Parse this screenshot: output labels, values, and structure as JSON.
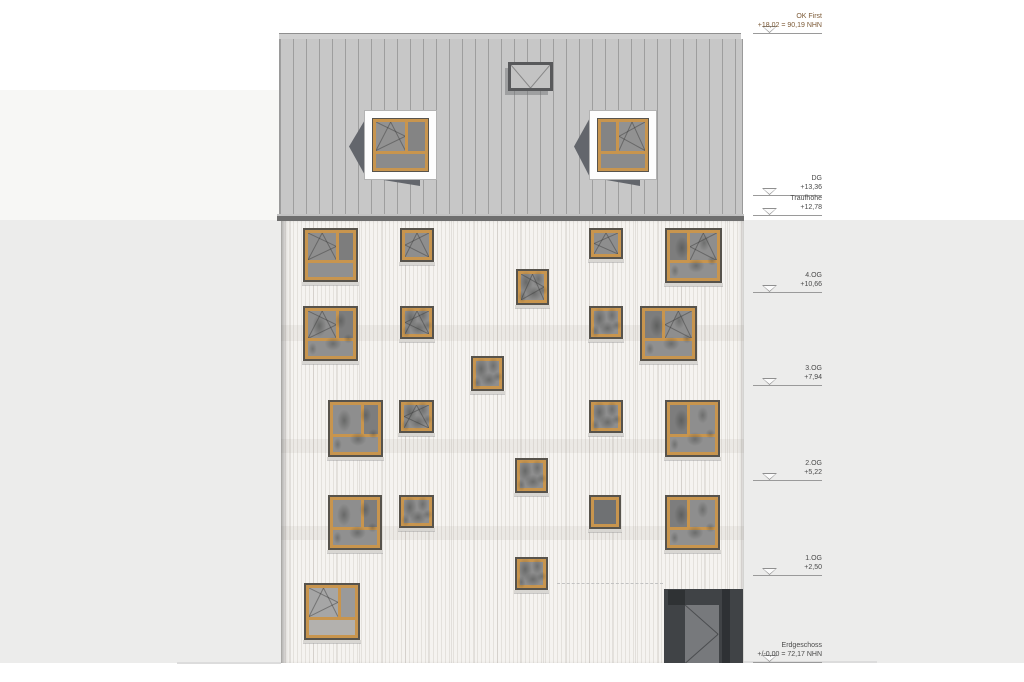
{
  "drawing": {
    "kind": "building-front-elevation",
    "colors": {
      "frame_orange": "#c8954e",
      "frame_outer": "#57534c",
      "glass": "#8e8e8e",
      "glass_dark": "#6f7173",
      "glass_light": "#a6a6a6",
      "roof": "#c7c7c7",
      "eaves": "#6e6e6e",
      "facade": "#f5f3f0",
      "dormer_shadow": "#63666c",
      "door_recess": "#404346",
      "door_leaf": "#77797c",
      "bg_band_upper": "#f7f7f5",
      "bg_band_lower": "#ececeb",
      "marker_accent": "#7c5a36"
    },
    "markers": [
      {
        "label": "OK First",
        "value": "+18,02 = 90,19 NHN",
        "y": 33,
        "accent": true
      },
      {
        "label": "DG",
        "value": "+13,36",
        "y": 195
      },
      {
        "label": "Traufhöhe",
        "value": "+12,78",
        "y": 215
      },
      {
        "label": "4.OG",
        "value": "+10,66",
        "y": 292
      },
      {
        "label": "3.OG",
        "value": "+7,94",
        "y": 385
      },
      {
        "label": "2.OG",
        "value": "+5,22",
        "y": 480
      },
      {
        "label": "1.OG",
        "value": "+2,50",
        "y": 575
      },
      {
        "label": "Erdgeschoss",
        "value": "+/-0,00 = 72,17 NHN",
        "y": 662
      }
    ],
    "structure": {
      "bands": [
        {
          "x": 0,
          "y": 90,
          "w": 290,
          "h": 130,
          "tone": "upper"
        },
        {
          "x": 0,
          "y": 220,
          "w": 1024,
          "h": 443,
          "tone": "lower"
        }
      ],
      "roof_ridge": {
        "x": 279,
        "y": 33,
        "w": 462,
        "h": 6
      },
      "roof_body": {
        "x": 279,
        "y": 39,
        "w": 462,
        "h": 175
      },
      "eaves": {
        "x": 277,
        "y": 214,
        "w": 467,
        "h": 7
      },
      "facade": {
        "x": 281,
        "y": 221,
        "w": 463,
        "h": 442
      },
      "ground_lines": [
        {
          "x": 177,
          "y": 662,
          "w": 104,
          "h": 2
        },
        {
          "x": 744,
          "y": 661,
          "w": 133,
          "h": 2
        }
      ],
      "dashed_line": {
        "x": 557,
        "y": 583,
        "w": 106
      }
    },
    "hatch": {
      "x": 508,
      "y": 62,
      "w": 45,
      "h": 29
    },
    "dormers": [
      {
        "x": 365,
        "y": 111,
        "w": 71,
        "h": 68,
        "mirror": false
      },
      {
        "x": 590,
        "y": 111,
        "w": 66,
        "h": 68,
        "mirror": true
      }
    ],
    "windows": [
      {
        "x": 303,
        "y": 228,
        "w": 55,
        "h": 54,
        "type": "large-left",
        "sym": "r"
      },
      {
        "x": 400,
        "y": 228,
        "w": 34,
        "h": 34,
        "type": "small",
        "sym": "l"
      },
      {
        "x": 589,
        "y": 228,
        "w": 34,
        "h": 31,
        "type": "small",
        "sym": "l"
      },
      {
        "x": 665,
        "y": 228,
        "w": 57,
        "h": 55,
        "type": "large-right",
        "sym": "l",
        "shade": true
      },
      {
        "x": 516,
        "y": 269,
        "w": 33,
        "h": 36,
        "type": "small",
        "sym": "r",
        "shade": true
      },
      {
        "x": 303,
        "y": 306,
        "w": 55,
        "h": 55,
        "type": "large-left",
        "sym": "r",
        "shade": true
      },
      {
        "x": 400,
        "y": 306,
        "w": 34,
        "h": 33,
        "type": "small",
        "sym": "l",
        "shade": true
      },
      {
        "x": 589,
        "y": 306,
        "w": 34,
        "h": 33,
        "type": "small",
        "shade": true
      },
      {
        "x": 640,
        "y": 306,
        "w": 57,
        "h": 55,
        "type": "large-right",
        "sym": "l",
        "shade": true
      },
      {
        "x": 471,
        "y": 356,
        "w": 33,
        "h": 35,
        "type": "small",
        "shade": true
      },
      {
        "x": 328,
        "y": 400,
        "w": 55,
        "h": 57,
        "type": "large-left",
        "shade": true
      },
      {
        "x": 399,
        "y": 400,
        "w": 35,
        "h": 33,
        "type": "small",
        "sym": "l",
        "shade": true
      },
      {
        "x": 589,
        "y": 400,
        "w": 34,
        "h": 33,
        "type": "small",
        "shade": true
      },
      {
        "x": 665,
        "y": 400,
        "w": 55,
        "h": 57,
        "type": "large-right",
        "shade": true
      },
      {
        "x": 515,
        "y": 458,
        "w": 33,
        "h": 35,
        "type": "small",
        "shade": true
      },
      {
        "x": 328,
        "y": 495,
        "w": 54,
        "h": 55,
        "type": "large-left",
        "shade": true
      },
      {
        "x": 399,
        "y": 495,
        "w": 35,
        "h": 33,
        "type": "small",
        "shade": true
      },
      {
        "x": 589,
        "y": 495,
        "w": 32,
        "h": 34,
        "type": "small-dark"
      },
      {
        "x": 665,
        "y": 495,
        "w": 55,
        "h": 55,
        "type": "large-right",
        "shade": true
      },
      {
        "x": 515,
        "y": 557,
        "w": 33,
        "h": 33,
        "type": "small",
        "shade": true
      },
      {
        "x": 304,
        "y": 583,
        "w": 56,
        "h": 57,
        "type": "eg-large",
        "sym": "r"
      }
    ],
    "door": {
      "x": 664,
      "y": 589,
      "w": 79,
      "h": 74
    }
  }
}
